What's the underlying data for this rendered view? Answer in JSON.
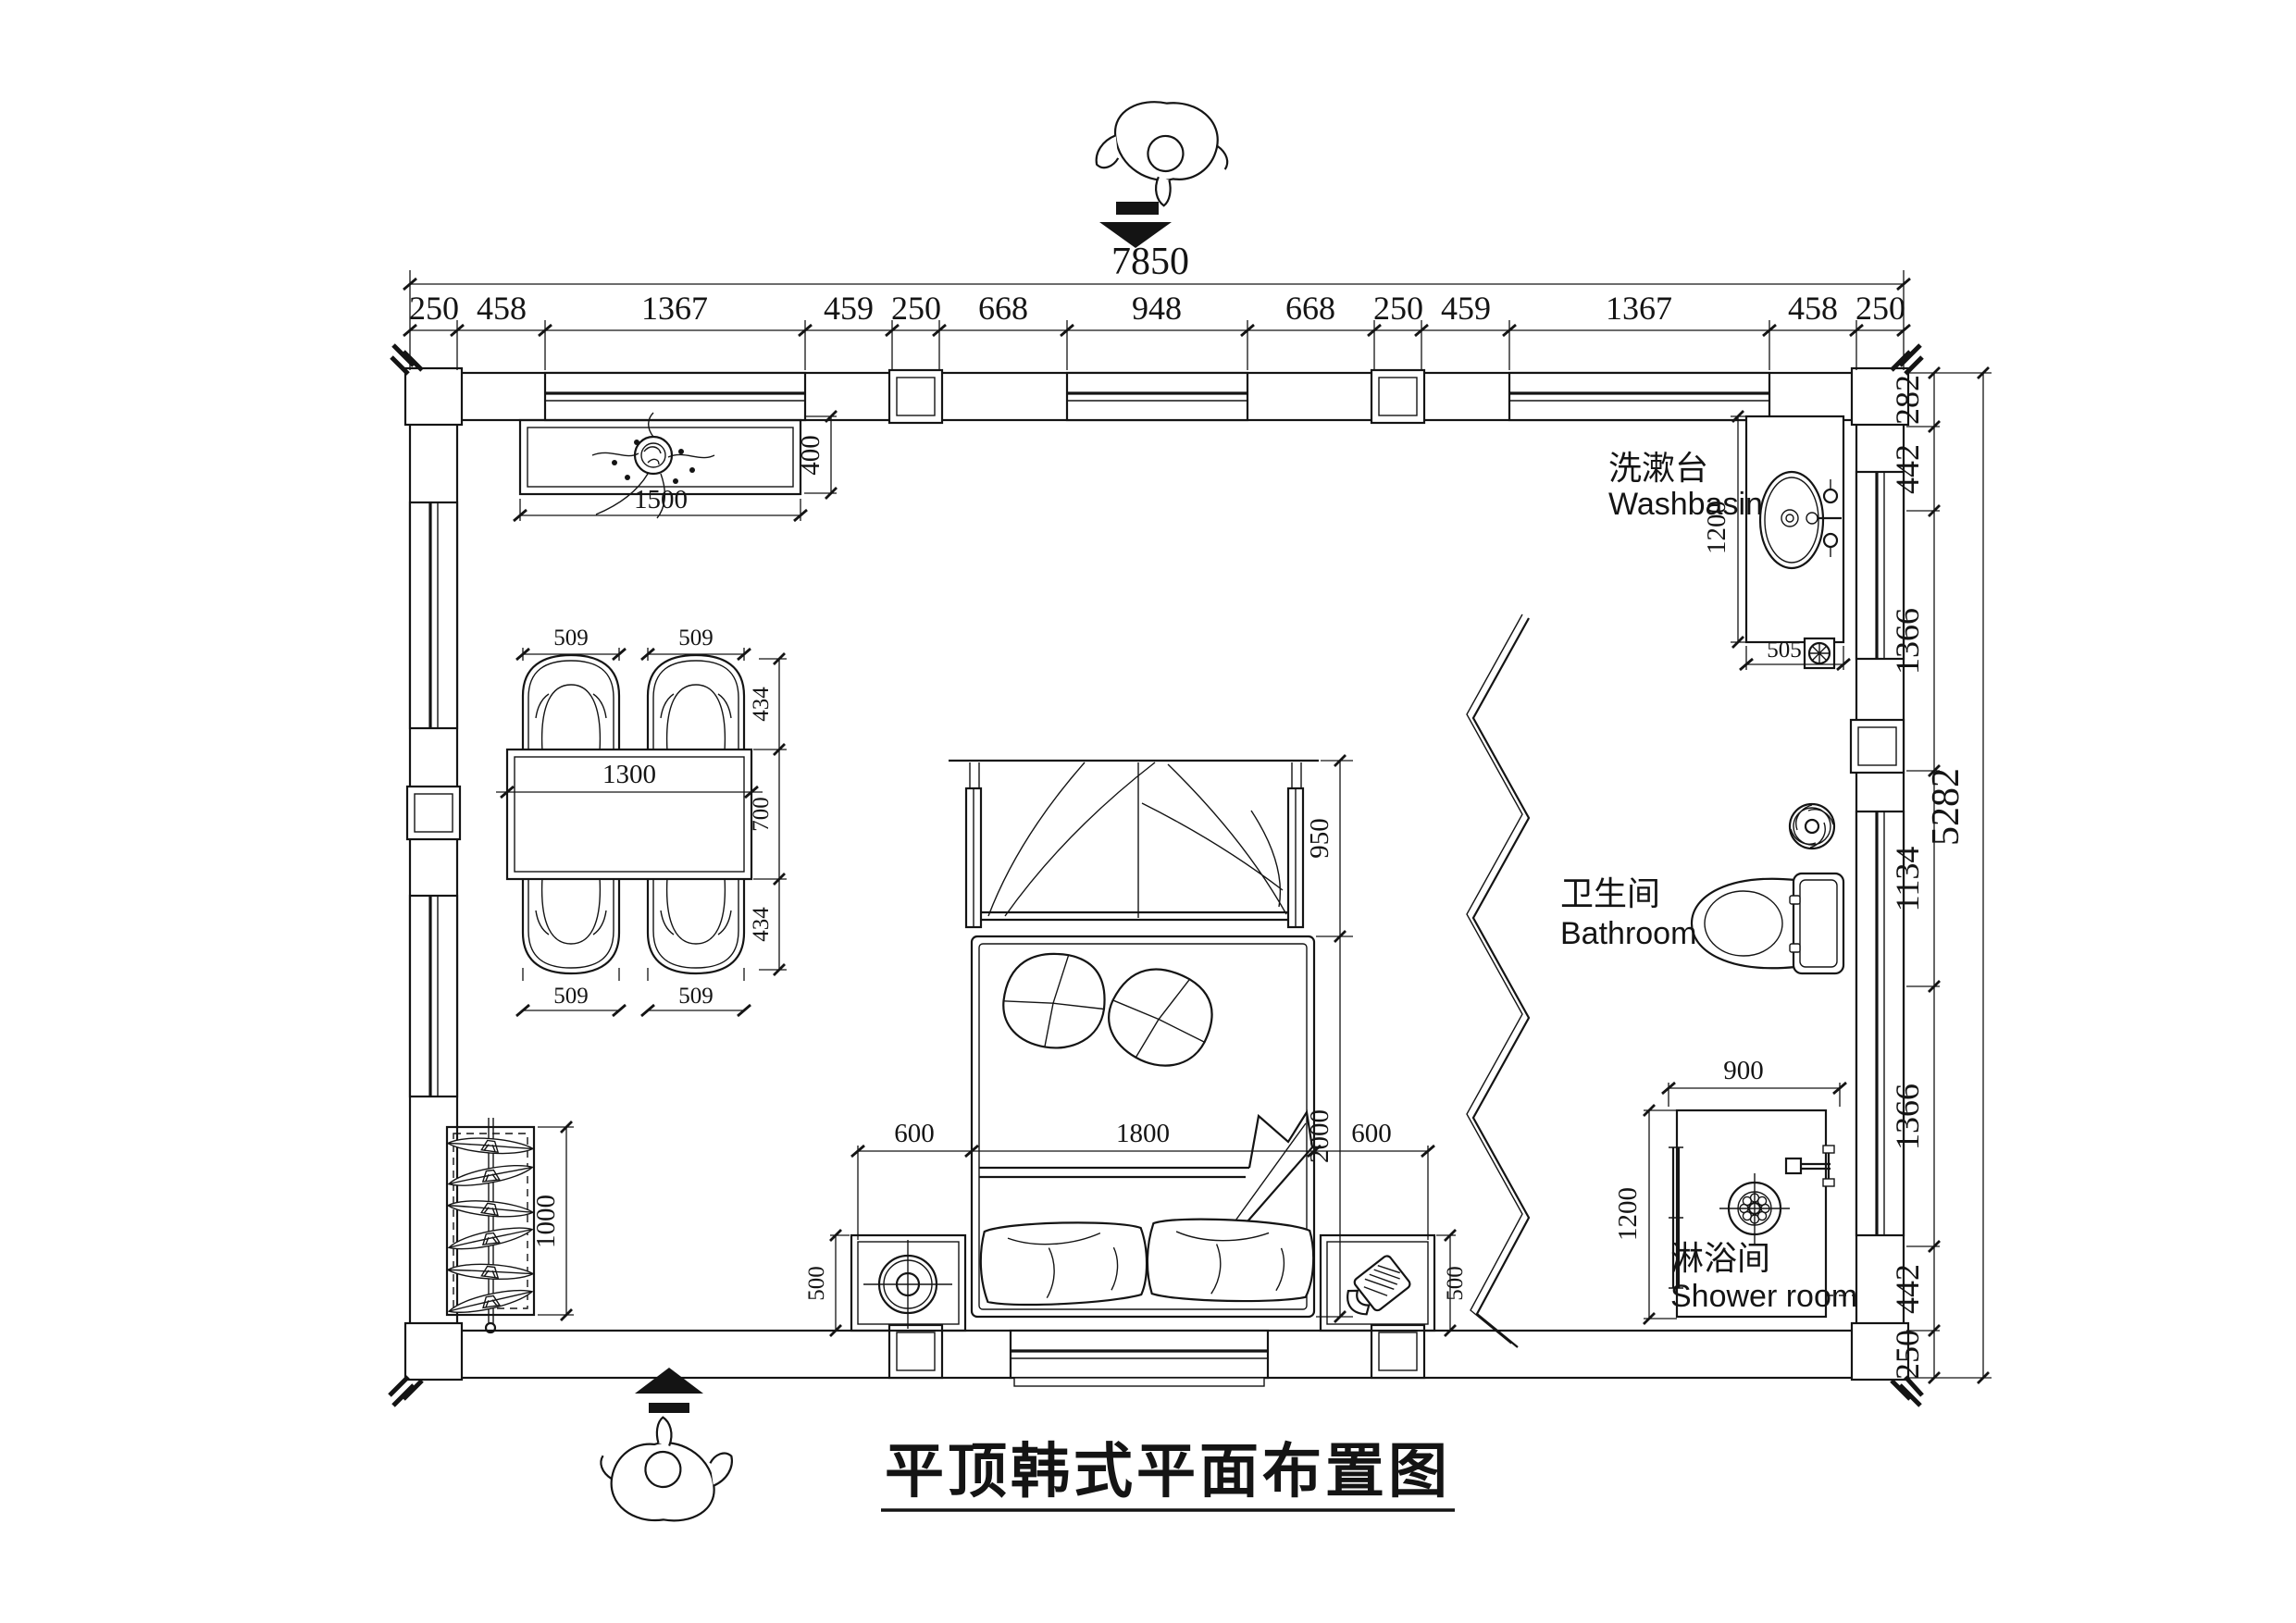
{
  "title": "平顶韩式平面布置图",
  "colors": {
    "line": "#141414",
    "background": "#ffffff"
  },
  "dims": {
    "top_total": "7850",
    "top_segments": [
      "250",
      "458",
      "1367",
      "459",
      "250",
      "668",
      "948",
      "668",
      "250",
      "459",
      "1367",
      "458",
      "250"
    ],
    "right_total": "5282",
    "right_segments": [
      "282",
      "442",
      "1366",
      "1134",
      "1366",
      "442",
      "250"
    ]
  },
  "rooms": {
    "washbasin_zh": "洗漱台",
    "washbasin_en": "Washbasin",
    "bathroom_zh": "卫生间",
    "bathroom_en": "Bathroom",
    "shower_zh": "淋浴间",
    "shower_en": "Shower room"
  },
  "furniture": {
    "cabinet_width": "1500",
    "cabinet_depth": "400",
    "table_length": "1300",
    "table_depth": "700",
    "chair_width": "509",
    "chair_depth": "434",
    "wardrobe_length": "1000",
    "bed_width": "1800",
    "bed_length": "2000",
    "bed_side_gap": "600",
    "canopy_depth": "950",
    "nightstand_depth": "500",
    "basin_counter_length": "1200",
    "basin_counter_width": "505",
    "shower_width": "900",
    "shower_depth": "1200"
  }
}
